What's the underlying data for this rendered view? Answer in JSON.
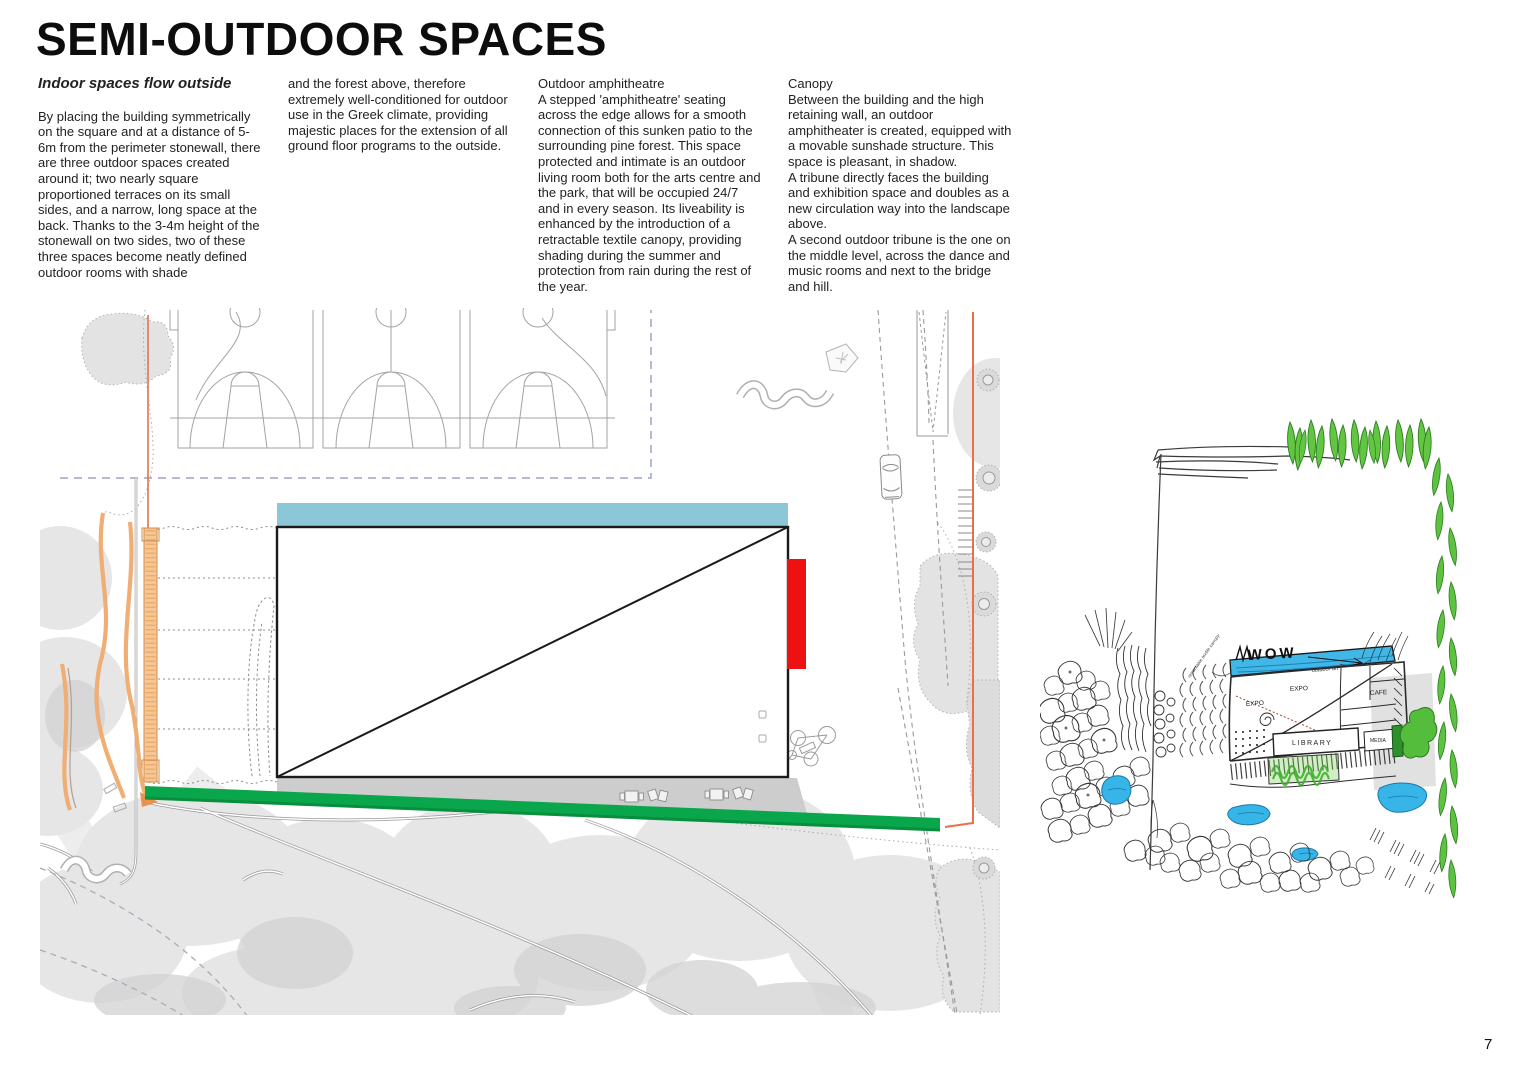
{
  "header": {
    "title": "SEMI-OUTDOOR SPACES",
    "columns": [
      {
        "heading": "Indoor spaces flow outside",
        "body": "By placing the building symmetrically on the square and at a distance of 5-6m from the perimeter stonewall, there are three outdoor spaces created around it; two nearly square proportioned terraces on its small sides, and a narrow, long space at the back. Thanks to the 3-4m height of the stonewall on two sides, two of these three spaces become neatly defined outdoor rooms with shade"
      },
      {
        "heading": "",
        "body": "and the forest above, therefore extremely well-conditioned for outdoor use in the Greek climate, providing majestic places for the extension of all ground floor programs to the outside."
      },
      {
        "heading": "Outdoor amphitheatre",
        "body": "A stepped 'amphitheatre' seating across the edge allows for a smooth connection of this sunken patio to the surrounding pine forest. This space protected and intimate is an outdoor living room both for the arts centre and the park, that will be occupied 24/7 and in every season. Its liveability is enhanced by the introduction of a retractable textile canopy, providing shading during the summer and protection from rain during the rest of the year."
      },
      {
        "heading": "Canopy",
        "body": "Between the building and the high retaining wall, an outdoor amphitheater is created, equipped with a movable sunshade structure. This space is pleasant, in shadow.\nA tribune directly faces the building and exhibition space and doubles as a new circulation way into the landscape above.\nA second outdoor tribune is the one on the middle level, across the dance and music rooms and next to the bridge and hill."
      }
    ]
  },
  "plan": {
    "colors": {
      "canopy_blue": "#8cc7d7",
      "tribune_red": "#ee1111",
      "path_green": "#0aa64b",
      "stonewall_orange": "#f0ad74",
      "boundary_orange": "#e8714a",
      "boundary_dashed_blue": "#9aa4c4",
      "tree_gray": "#e4e4e4",
      "shadow_gray": "#cdcdcd"
    }
  },
  "sketch": {
    "labels": {
      "wow": "WOW",
      "expo_upper": "EXPO",
      "expo_lower": "EXPO",
      "cafe": "CAFE",
      "library": "LIBRARY",
      "media": "MEDIA",
      "annotation_canopy": "retractable textile canopy",
      "annotation_outdoor_art": "outdoor art"
    }
  },
  "page": {
    "number": "7"
  }
}
